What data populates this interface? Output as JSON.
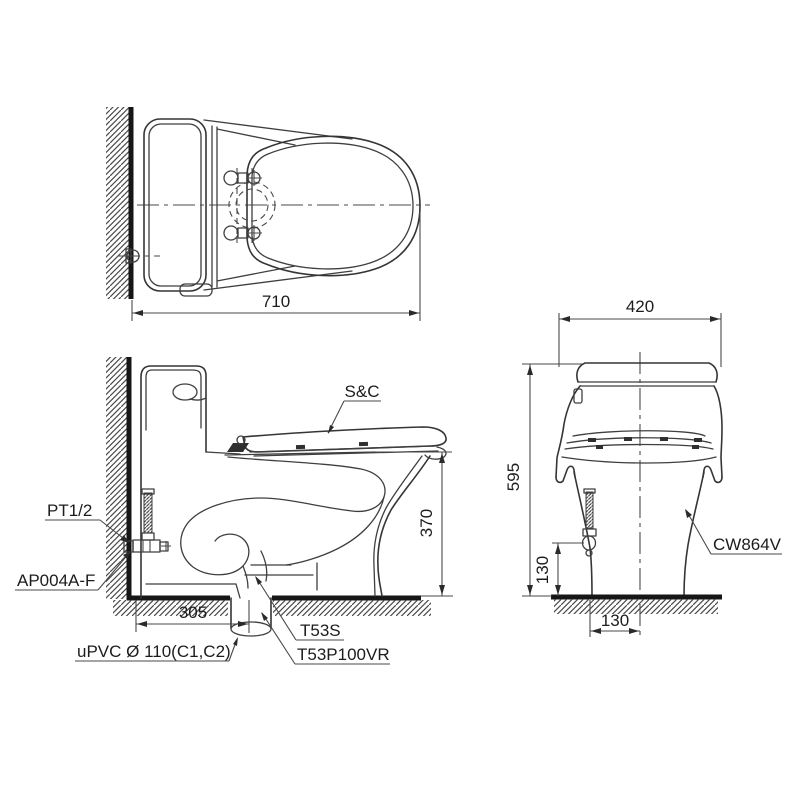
{
  "drawing": {
    "labels": {
      "seat_cover": "S&C",
      "water_inlet": "PT1/2",
      "stop_valve": "AP004A-F",
      "drain_pipe": "uPVC Ø 110(C1,C2)",
      "flange_t53s": "T53S",
      "flange_t53p": "T53P100VR",
      "model": "CW864V"
    },
    "dimensions": {
      "overall_depth": "710",
      "overall_width": "420",
      "overall_height": "595",
      "seat_height": "370",
      "inlet_height": "130",
      "inlet_offset": "130",
      "rough_in": "305"
    },
    "colors": {
      "line": "#3f3f3f",
      "heavy_line": "#161616",
      "text": "#1c1c1c",
      "background": "#ffffff"
    }
  }
}
